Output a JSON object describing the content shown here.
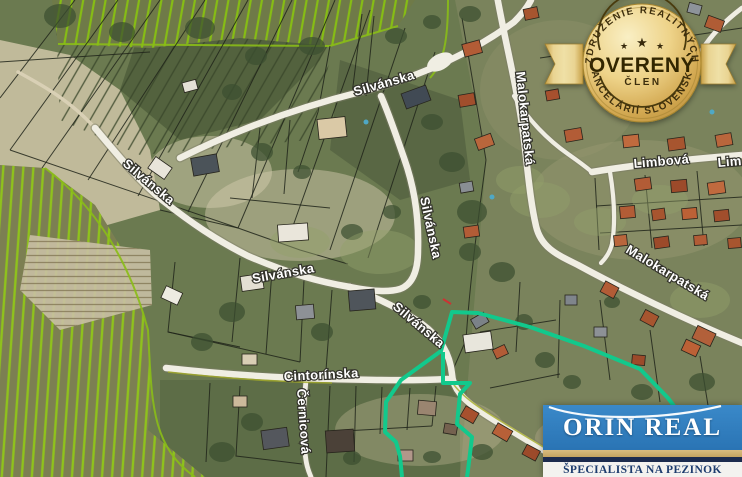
{
  "map": {
    "street_labels": [
      {
        "id": "silvanska-top",
        "text": "Silvánska"
      },
      {
        "id": "silvanska-west",
        "text": "Silvánska"
      },
      {
        "id": "silvanska-mid",
        "text": "Silvánska"
      },
      {
        "id": "silvanska-vertical",
        "text": "Silvánska"
      },
      {
        "id": "silvanska-se",
        "text": "Silvánska"
      },
      {
        "id": "malokarpatska-vertical",
        "text": "Malokarpatská"
      },
      {
        "id": "malokarpatska-diagonal",
        "text": "Malokarpatská"
      },
      {
        "id": "limbova",
        "text": "Limbová"
      },
      {
        "id": "limbova-right-edge",
        "text": "Lim"
      },
      {
        "id": "cintorinska",
        "text": "Cintorínska"
      },
      {
        "id": "cernicova",
        "text": "Černicová"
      }
    ],
    "highlight_color": "#12C98C"
  },
  "badge": {
    "arc_top": "ZDRUŽENIE REALITNÝCH",
    "title": "OVERENÝ",
    "subtitle": "ČLEN",
    "arc_bottom": "KANCELÁRIÍ SLOVENSKA",
    "star": "★",
    "gold_color": "#D9BC6A"
  },
  "logo": {
    "title": "ORIN REAL",
    "subtitle": "ŠPECIALISTA NA PEZINOK",
    "blue": "#2E7DBE",
    "navy": "#1C2B4E",
    "tan": "#CDB274"
  }
}
